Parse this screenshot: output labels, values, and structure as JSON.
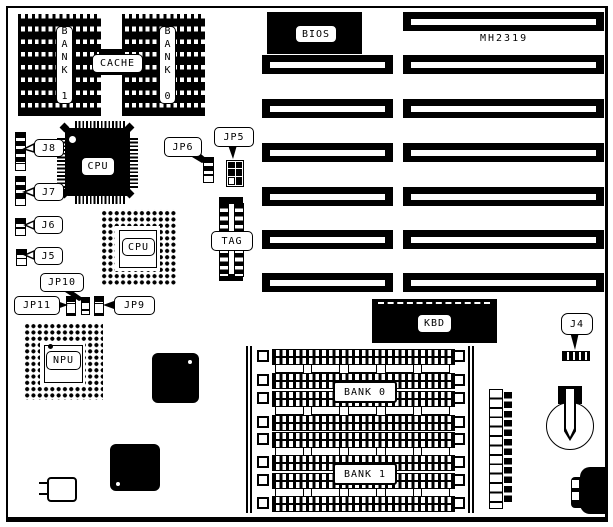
{
  "part_number": "MH2319",
  "cache_area": {
    "bank1": "BANK 1",
    "cache": "CACHE",
    "bank0": "BANK 0"
  },
  "chips": {
    "bios": "BIOS",
    "cpu": "CPU",
    "cpu_socket": "CPU",
    "npu": "NPU",
    "tag": "TAG",
    "kbd": "KBD"
  },
  "simm": {
    "bank0": "BANK 0",
    "bank1": "BANK 1"
  },
  "jumpers": {
    "j4": "J4",
    "j5": "J5",
    "j6": "J6",
    "j7": "J7",
    "j8": "J8",
    "jp5": "JP5",
    "jp6": "JP6",
    "jp9": "JP9",
    "jp10": "JP10",
    "jp11": "JP11"
  },
  "colors": {
    "ink": "#000000",
    "paper": "#ffffff"
  }
}
